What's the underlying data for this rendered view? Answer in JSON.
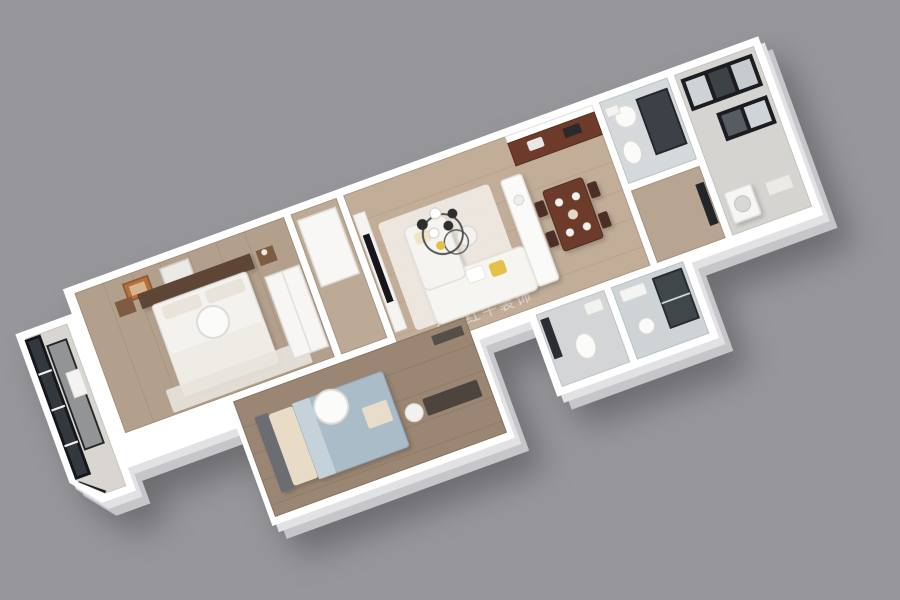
{
  "scene": {
    "type": "3d-floorplan-render",
    "view": "axonometric top-down, rotated about -20 degrees, long axis lower-left to upper-right"
  },
  "watermark": {
    "text": "红牛装饰",
    "color": "#ffffff"
  },
  "palette": {
    "background": "#97969b",
    "wall": "#ffffff",
    "wallSide": "#c6c5c9",
    "wallBevel": "#e2e1e4",
    "woodLight": "#b3a08c",
    "woodHall": "#bcaa96",
    "woodMid": "#c1ad98",
    "woodCorridor": "#b8a591",
    "woodDark": "#9a8672",
    "tileBalconyLeft": "#d9d6d1",
    "tileBalconyRight": "#d6d4d0",
    "tileBathTop": "#d6d9db",
    "tileBathA": "#d3d5d6",
    "tileBathB": "#ced3d6",
    "glassDark": "#31373d",
    "frameBlack": "#1b1e21",
    "kitchenWood": "#6e3b2c",
    "diningWood": "#6d3a2b",
    "chairWood": "#4e2f26",
    "headboardWood": "#5e4434",
    "nightstandWood": "#7d5b43",
    "bedBlue": "#a9bcc8",
    "blanketBeige": "#e8dcc6",
    "accentYellow": "#e7c04a",
    "sofaWhite": "#f7f5f1",
    "lampWhite": "#fbfbf9",
    "tvBlack": "#17181a",
    "deskDark": "#4d453e",
    "doorDark": "#2b2e32",
    "artFrameOrange": "#b4703c"
  },
  "rooms": [
    {
      "id": "balcony-left",
      "kind": "balcony with black-framed floor-to-ceiling glazing"
    },
    {
      "id": "bedroom-master",
      "kind": "bedroom, white bed, dark headboard, wall art, wardrobe"
    },
    {
      "id": "bedroom-second",
      "kind": "bedroom, blue-gray bed, desk, round ceiling lamp"
    },
    {
      "id": "hallway",
      "kind": "hall with closet"
    },
    {
      "id": "living-dining",
      "kind": "open living room with L-sofa, chandelier, TV wall"
    },
    {
      "id": "kitchen",
      "kind": "kitchen, dark red-brown cabinets, white island, dining table"
    },
    {
      "id": "bathroom-a",
      "kind": "bathroom, gray tile, toilet"
    },
    {
      "id": "bathroom-b",
      "kind": "bathroom, gray tile, glass shower"
    },
    {
      "id": "shower-room-top",
      "kind": "shower room with dark glass panel and ceiling lamp"
    },
    {
      "id": "balcony-right",
      "kind": "utility balcony, black window frames, washer"
    }
  ]
}
